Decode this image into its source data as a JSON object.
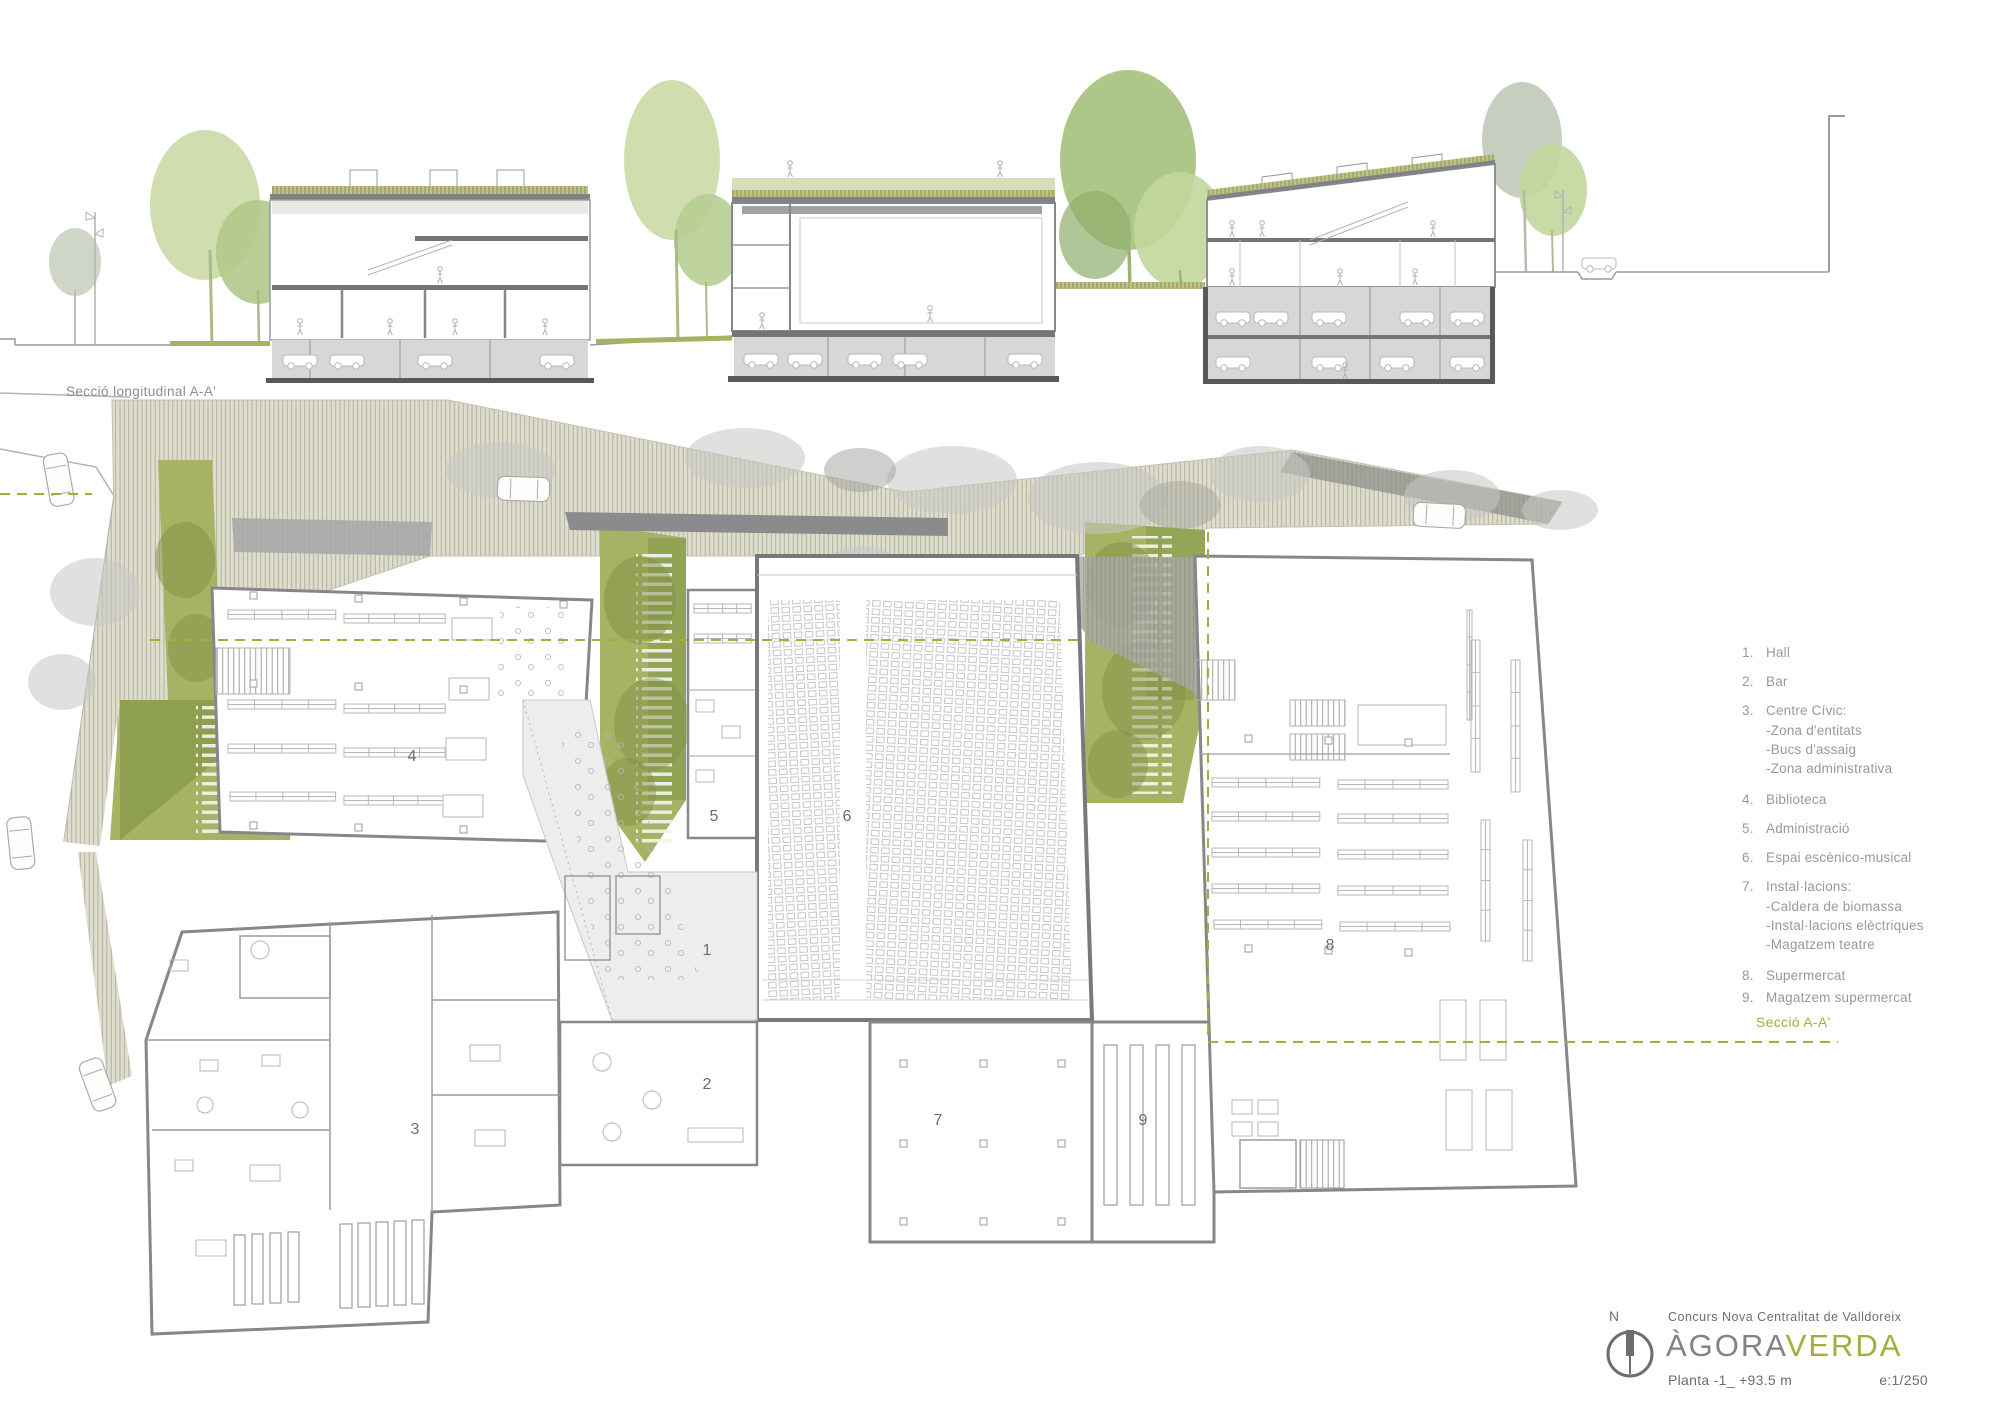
{
  "section_drawing": {
    "caption": "Secció longitudinal A-A'"
  },
  "legend": {
    "items": [
      {
        "number": "1.",
        "label": "Hall"
      },
      {
        "number": "2.",
        "label": "Bar"
      },
      {
        "number": "3.",
        "label": "Centre Cívic:",
        "sub": [
          "-Zona d'entitats",
          "-Bucs d'assaig",
          "-Zona administrativa"
        ]
      },
      {
        "number": "4.",
        "label": "Biblioteca"
      },
      {
        "number": "5.",
        "label": "Administració"
      },
      {
        "number": "6.",
        "label": "Espai escènico-musical"
      },
      {
        "number": "7.",
        "label": "Instal·lacions:",
        "sub": [
          "-Caldera de biomassa",
          "-Instal·lacions elèctriques",
          "-Magatzem teatre"
        ]
      },
      {
        "number": "8.",
        "label": "Supermercat"
      },
      {
        "number": "9.",
        "label": "Magatzem supermercat"
      }
    ]
  },
  "section_marker": {
    "label": "Secció A-A'"
  },
  "plan": {
    "numbers": [
      "1",
      "2",
      "3",
      "4",
      "5",
      "6",
      "7",
      "8",
      "9"
    ]
  },
  "titleblock": {
    "north_letter": "N",
    "competition": "Concurs Nova Centralitat de Valldoreix",
    "project_gray": "ÀGORA",
    "project_green": "VERDA",
    "sheet": "Planta -1_ +93.5 m",
    "scale": "e:1/250"
  },
  "colors": {
    "accent_green": "#a3ae3b",
    "garden_green": "#a6b264",
    "wall_gray": "#85878a",
    "basement_gray": "#d6d7d8",
    "hatch_beige": "#dfddcc",
    "text_gray": "#97999b"
  }
}
